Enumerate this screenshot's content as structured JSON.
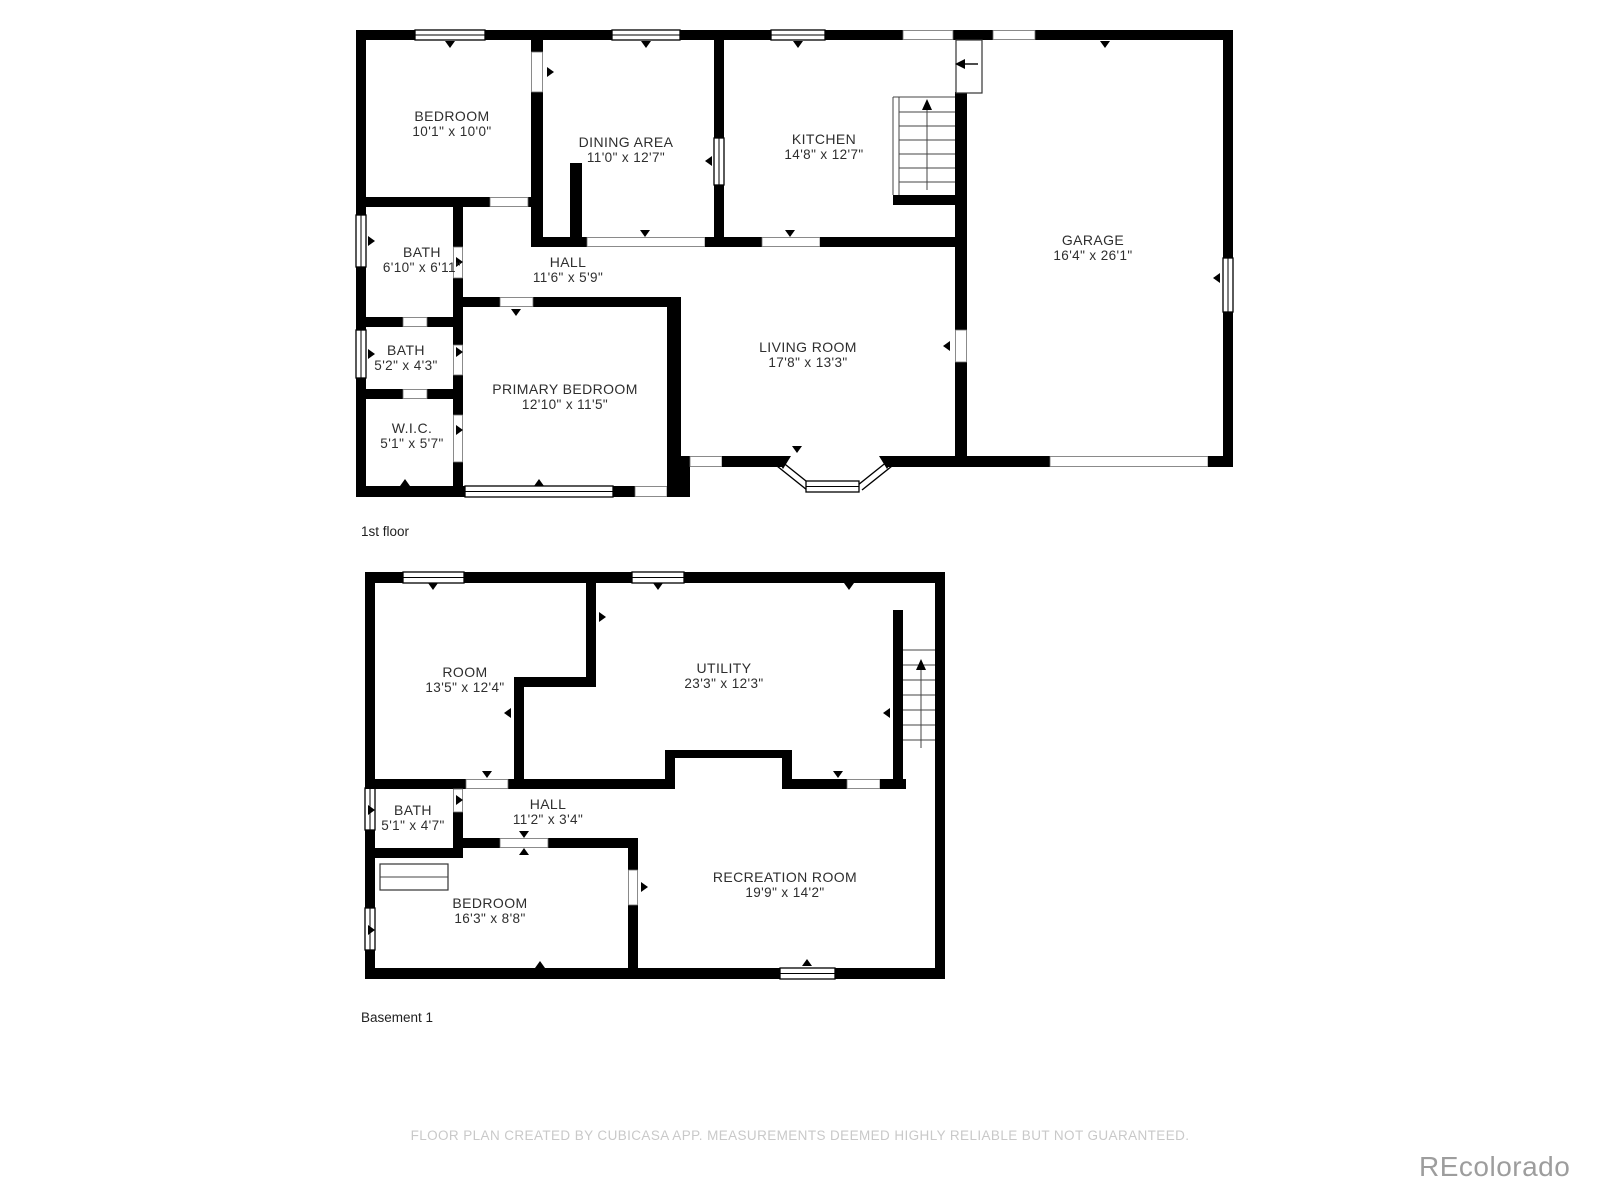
{
  "floors": [
    {
      "label": "1st floor",
      "rooms": [
        {
          "name": "BEDROOM",
          "dims": "10'1\" x 10'0\""
        },
        {
          "name": "DINING AREA",
          "dims": "11'0\" x 12'7\""
        },
        {
          "name": "KITCHEN",
          "dims": "14'8\" x 12'7\""
        },
        {
          "name": "GARAGE",
          "dims": "16'4\" x 26'1\""
        },
        {
          "name": "BATH",
          "dims": "6'10\" x 6'11\""
        },
        {
          "name": "HALL",
          "dims": "11'6\" x 5'9\""
        },
        {
          "name": "BATH",
          "dims": "5'2\" x 4'3\""
        },
        {
          "name": "W.I.C.",
          "dims": "5'1\" x 5'7\""
        },
        {
          "name": "PRIMARY BEDROOM",
          "dims": "12'10\" x 11'5\""
        },
        {
          "name": "LIVING ROOM",
          "dims": "17'8\" x 13'3\""
        }
      ]
    },
    {
      "label": "Basement 1",
      "rooms": [
        {
          "name": "ROOM",
          "dims": "13'5\" x 12'4\""
        },
        {
          "name": "UTILITY",
          "dims": "23'3\" x 12'3\""
        },
        {
          "name": "BATH",
          "dims": "5'1\" x 4'7\""
        },
        {
          "name": "HALL",
          "dims": "11'2\" x 3'4\""
        },
        {
          "name": "BEDROOM",
          "dims": "16'3\" x 8'8\""
        },
        {
          "name": "RECREATION ROOM",
          "dims": "19'9\" x 14'2\""
        }
      ]
    }
  ],
  "footer": {
    "disclaimer": "FLOOR PLAN CREATED BY CUBICASA APP. MEASUREMENTS DEEMED HIGHLY RELIABLE BUT NOT GUARANTEED."
  },
  "watermark": {
    "text": "REcolorado"
  },
  "colors": {
    "wall": "#000000",
    "background": "#ffffff",
    "footer_text": "#c9c9c9",
    "watermark_text": "#9d9d9d"
  }
}
